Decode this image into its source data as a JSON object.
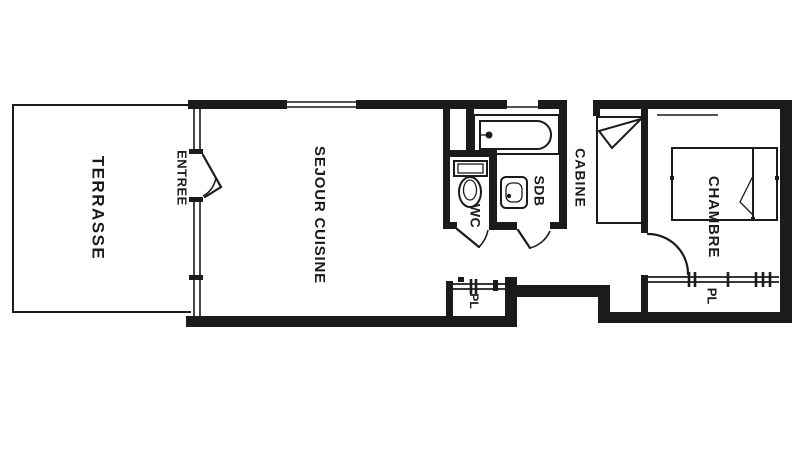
{
  "title": "Apartment floor plan",
  "rooms": {
    "terrasse": {
      "label": "TERRASSE"
    },
    "entree": {
      "label": "ENTREE"
    },
    "sejour": {
      "label": "SEJOUR CUISINE"
    },
    "wc": {
      "label": "WC"
    },
    "sdb": {
      "label": "SDB"
    },
    "cabine": {
      "label": "CABINE"
    },
    "chambre": {
      "label": "CHAMBRE"
    },
    "placard_chambre": {
      "label": "PL"
    },
    "placard_sejour": {
      "label": "PL"
    }
  },
  "colors": {
    "wall": "#1b1b1b",
    "background": "#ffffff"
  }
}
